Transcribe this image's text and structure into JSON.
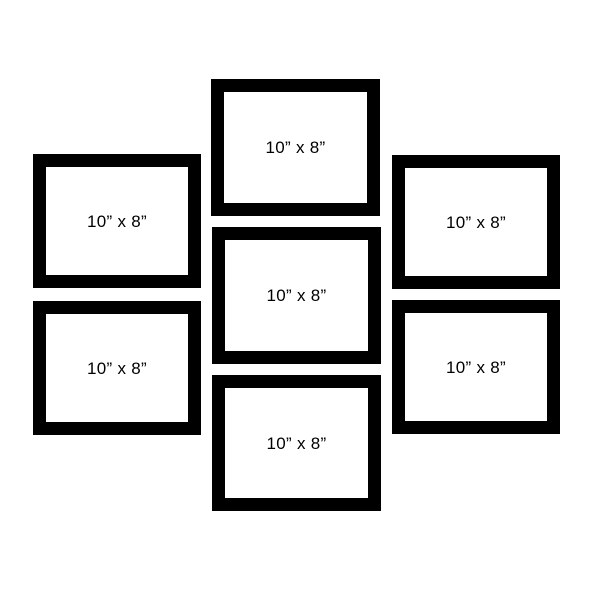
{
  "layout_title": "gallery-wall-frame-set",
  "colors": {
    "background": "#ffffff",
    "frame_border": "#000000",
    "frame_mat": "#ffffff",
    "label_text": "#000000"
  },
  "frames": [
    {
      "position": "middle-top",
      "label": "10” x 8”"
    },
    {
      "position": "left-top",
      "label": "10” x 8”"
    },
    {
      "position": "right-top",
      "label": "10” x 8”"
    },
    {
      "position": "middle-center",
      "label": "10” x 8”"
    },
    {
      "position": "left-bottom",
      "label": "10” x 8”"
    },
    {
      "position": "right-bottom",
      "label": "10” x 8”"
    },
    {
      "position": "middle-bottom",
      "label": "10” x 8”"
    }
  ]
}
